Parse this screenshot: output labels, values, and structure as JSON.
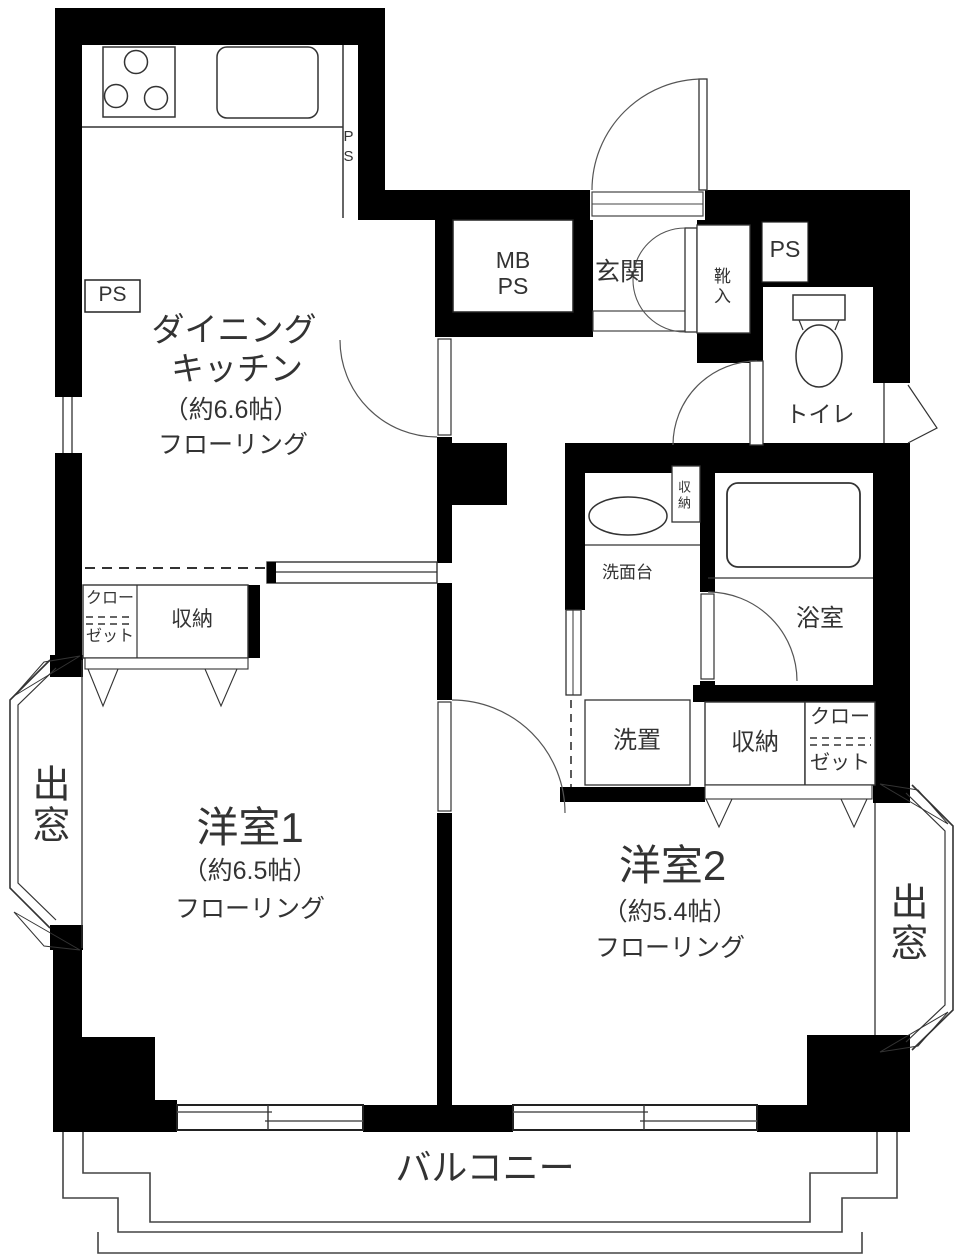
{
  "title": "apartment floor plan",
  "colors": {
    "wall": "#000000",
    "line": "#333333",
    "background": "#ffffff"
  },
  "rooms": {
    "dining_kitchen": {
      "name_line1": "ダイニング",
      "name_line2": "キッチン",
      "size": "（約6.6帖）",
      "flooring": "フローリング"
    },
    "western_room_1": {
      "name": "洋室1",
      "size": "（約6.5帖）",
      "flooring": "フローリング"
    },
    "western_room_2": {
      "name": "洋室2",
      "size": "（約5.4帖）",
      "flooring": "フローリング"
    },
    "entrance": {
      "label": "玄関"
    },
    "toilet": {
      "label": "トイレ"
    },
    "bathroom": {
      "label": "浴室"
    },
    "washroom": {
      "label": "洗面台"
    },
    "laundry": {
      "label": "洗置"
    },
    "balcony": {
      "label": "バルコニー"
    }
  },
  "storage": {
    "shoe_cabinet": "靴入",
    "storage_room1": "収納",
    "closet_room1_line1": "クロー",
    "closet_room1_line2": "ゼット",
    "storage_room2": "収納",
    "closet_room2_line1": "クロー",
    "closet_room2_line2": "ゼット",
    "storage_washroom": "収納"
  },
  "shafts": {
    "ps_kitchen_top": "PS",
    "ps_kitchen_box": "PS",
    "mb_line1": "MB",
    "mb_line2": "PS",
    "ps_entrance": "PS"
  },
  "bay_windows": {
    "left": "出窓",
    "right": "出窓"
  }
}
